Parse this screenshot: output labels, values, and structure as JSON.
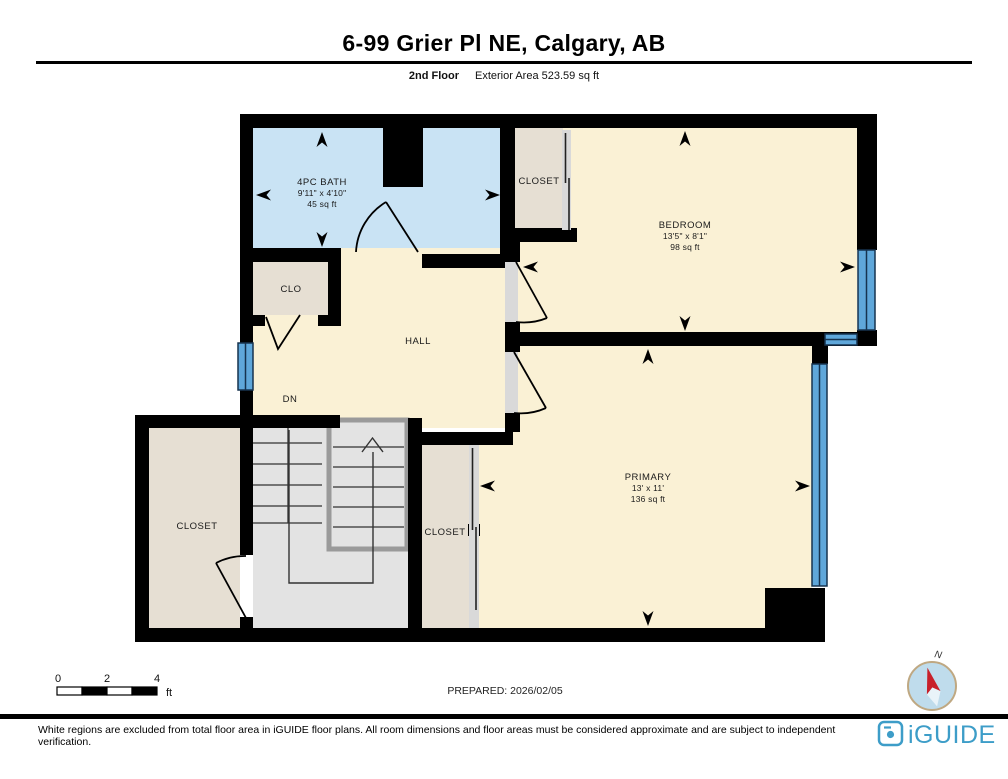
{
  "header": {
    "title": "6-99 Grier Pl NE, Calgary, AB",
    "floor_label": "2nd Floor",
    "area_label": "Exterior Area 523.59 sq ft"
  },
  "rooms": [
    {
      "name": "4PC BATH",
      "dimensions": "9'11\" x 4'10\"",
      "area": "45 sq ft"
    },
    {
      "name": "BEDROOM",
      "dimensions": "13'5\" x 8'1\"",
      "area": "98 sq ft"
    },
    {
      "name": "PRIMARY",
      "dimensions": "13' x 11'",
      "area": "136 sq ft"
    }
  ],
  "labels": {
    "closet_top": "CLOSET",
    "closet_left": "CLOSET",
    "closet_right": "CLOSET",
    "clo": "CLO",
    "hall": "HALL",
    "dn": "DN"
  },
  "scale_bar": {
    "tick_0": "0",
    "tick_2": "2",
    "tick_4": "4",
    "unit": "ft"
  },
  "prepared": "PREPARED: 2026/02/05",
  "compass": {
    "north_label": "N"
  },
  "footer": {
    "disclaimer": "White regions are excluded from total floor area in iGUIDE floor plans. All room dimensions and floor areas must be considered approximate and are subject to independent verification.",
    "logo_text": "iGUIDE"
  },
  "colors": {
    "bath": "#c9e3f4",
    "room": "#faf1d5",
    "closet": "#e6dfd3",
    "stairs": "#e3e3e3",
    "window_fill": "#5fa7da",
    "compass_fill": "#bfdcec",
    "compass_red": "#c8202a",
    "logo_blue": "#3d9dc8"
  }
}
